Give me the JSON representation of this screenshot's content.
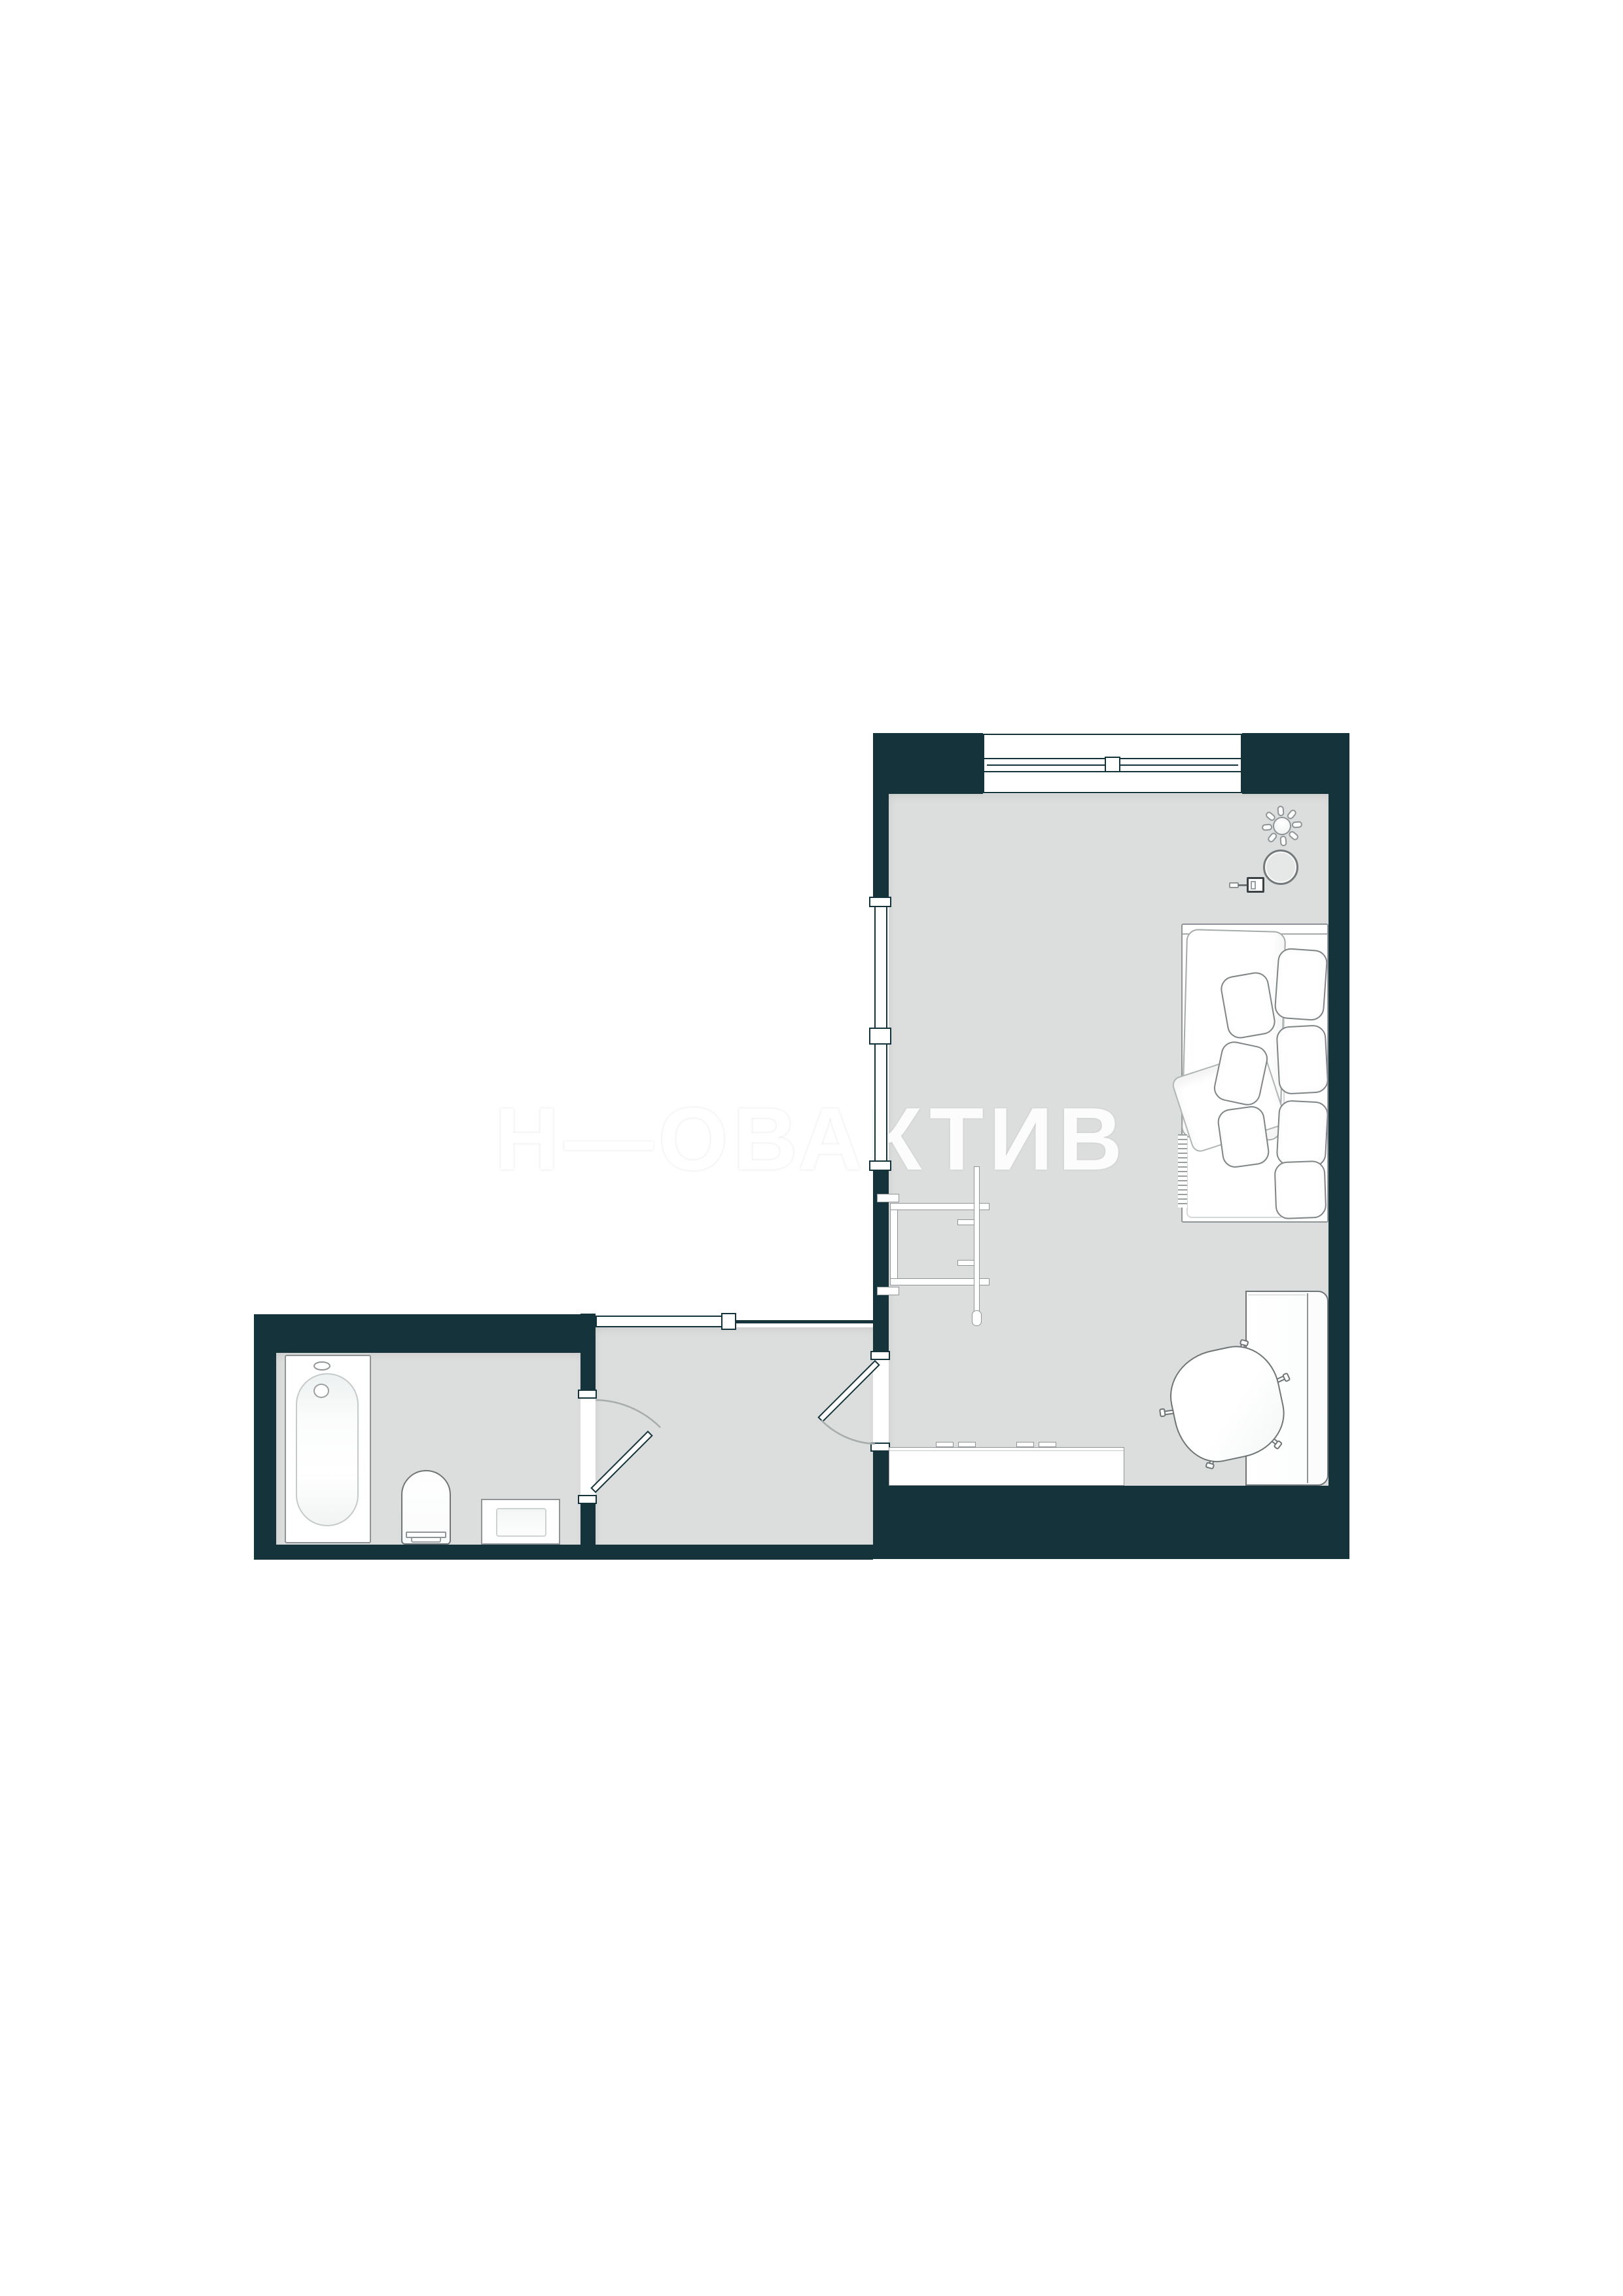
{
  "watermark": {
    "text": "Н—ОВАКТИВ"
  },
  "palette": {
    "wall": "#14333b",
    "floor": "#dcdddd",
    "outline": "#8f9596",
    "background": "#ffffff",
    "furniture_fill": "#ffffff"
  },
  "plan": {
    "type": "apartment-floor-plan",
    "rooms": [
      {
        "name": "living-room",
        "features": [
          "window",
          "balcony-glazing",
          "interior-door"
        ],
        "furniture": [
          "ceiling-light",
          "round-mirror",
          "wall-sconce",
          "sofa-bed",
          "pillows",
          "blanket",
          "clothes-rack",
          "kitchen-counter",
          "desk",
          "office-chair"
        ]
      },
      {
        "name": "hallway",
        "features": [
          "entry-door",
          "door-to-living-room",
          "door-to-bathroom"
        ],
        "furniture": []
      },
      {
        "name": "bathroom",
        "features": [
          "interior-door"
        ],
        "furniture": [
          "bathtub",
          "toilet",
          "sink-cabinet"
        ]
      }
    ]
  }
}
